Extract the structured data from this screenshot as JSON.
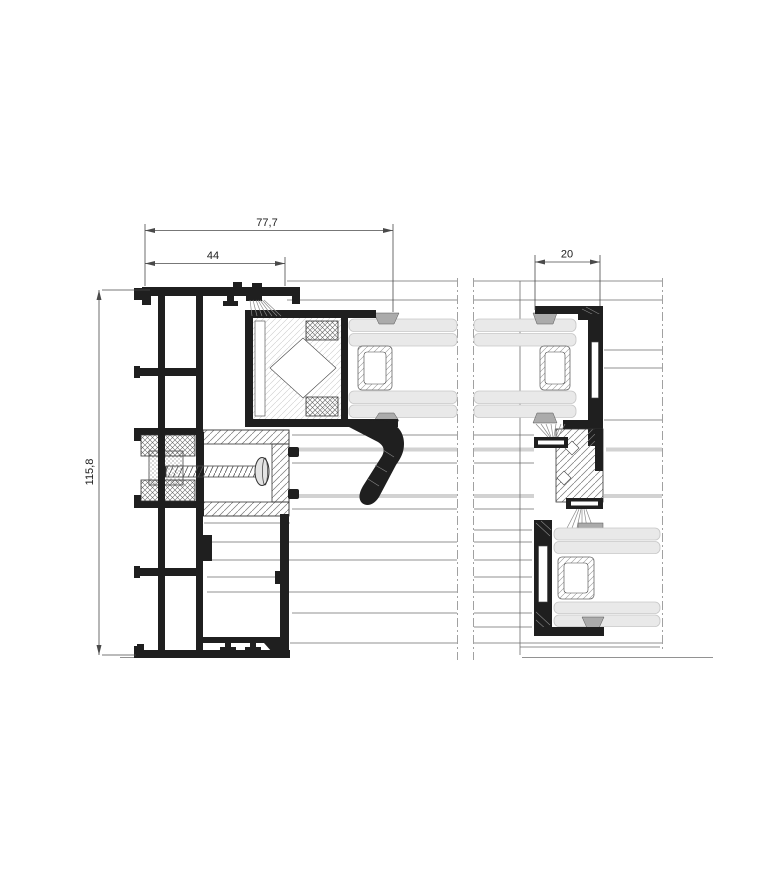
{
  "drawing": {
    "type": "aluminium sliding window profile cross-section detail",
    "dimensions": {
      "overall_width_mm": "77,7",
      "frame_width_mm": "44",
      "interlock_width_mm": "20",
      "overall_height_mm": "115,8"
    },
    "colors": {
      "background": "#ffffff",
      "profile": "#1f1f1f",
      "glass": "#e9e9e9",
      "glass-edge": "#c6c6c6",
      "gasket": "#ababab",
      "dim-line": "#4a4a4a",
      "thin-line": "#6e6e6e",
      "gray-band": "#d2d2d2"
    }
  }
}
